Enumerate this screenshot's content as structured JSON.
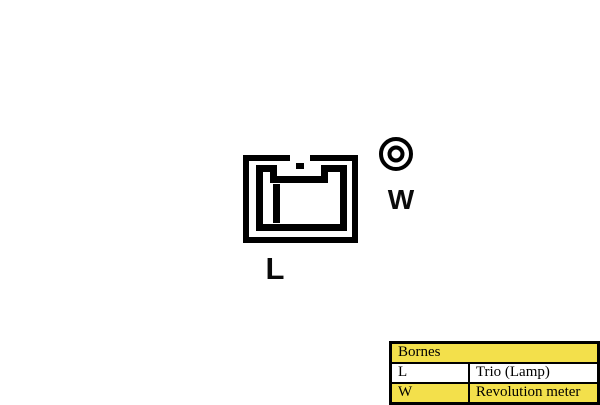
{
  "diagram": {
    "terminals": [
      {
        "id": "L",
        "label": "L"
      },
      {
        "id": "W",
        "label": "W"
      }
    ]
  },
  "legend_table": {
    "title": "Bornes",
    "rows": [
      {
        "terminal": "L",
        "function": "Trio (Lamp)"
      },
      {
        "terminal": "W",
        "function": "Revolution meter"
      }
    ]
  },
  "colors": {
    "line": "#000000",
    "background": "#ffffff",
    "table_highlight": "#F3E04B"
  }
}
